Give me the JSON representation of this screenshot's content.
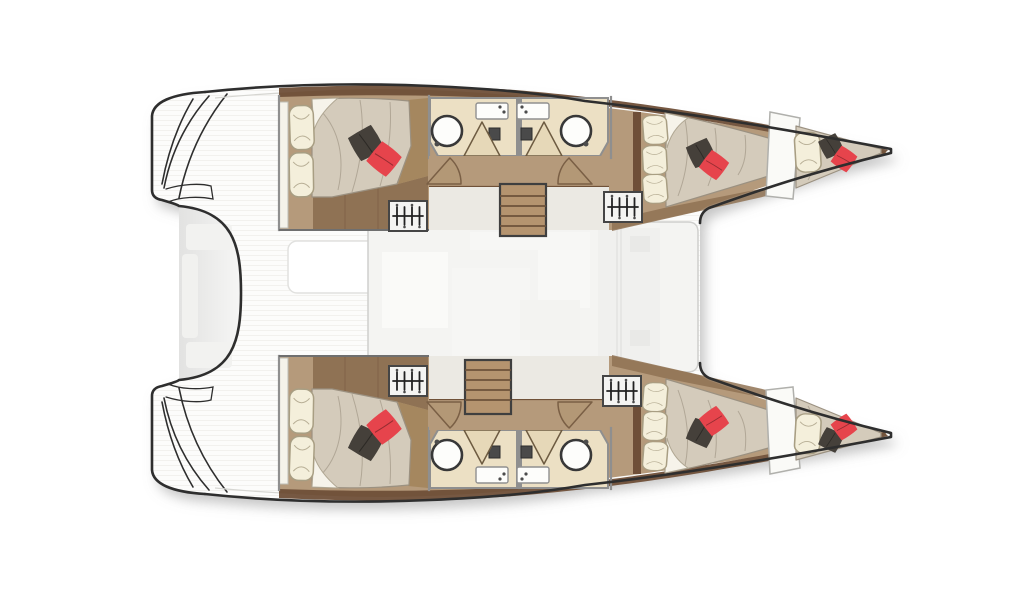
{
  "figure": {
    "type": "floor-plan",
    "subject": "catamaran-yacht-layout",
    "description": "Top-down floor plan of a sailing catamaran: four double cabins with red and charcoal accent cushions, two bathrooms with round showers and sinks, two bow berths, central saloon, aft cockpit and twin stepped transoms."
  },
  "palette": {
    "page_bg": "#ffffff",
    "hull_fill": "#fcfcfb",
    "outline": "#2e2e2e",
    "wood": "#b59a7b",
    "wood_mid": "#8f7254",
    "wood_dark": "#6f4f38",
    "bathroom_floor": "#ece0c4",
    "fixture_white": "#fdfdfb",
    "wall_gray": "#8f8f8f",
    "mattress": "#d4cbbb",
    "mattress_line": "#a89e8d",
    "pillow": "#f4efdb",
    "pillow_line": "#a89e83",
    "cushion_dark": "#45403a",
    "cushion_red": "#e6444c",
    "saloon_fill": "#f4f4f2",
    "stairs": "#b5946f",
    "stairs_line": "#6d523a"
  }
}
